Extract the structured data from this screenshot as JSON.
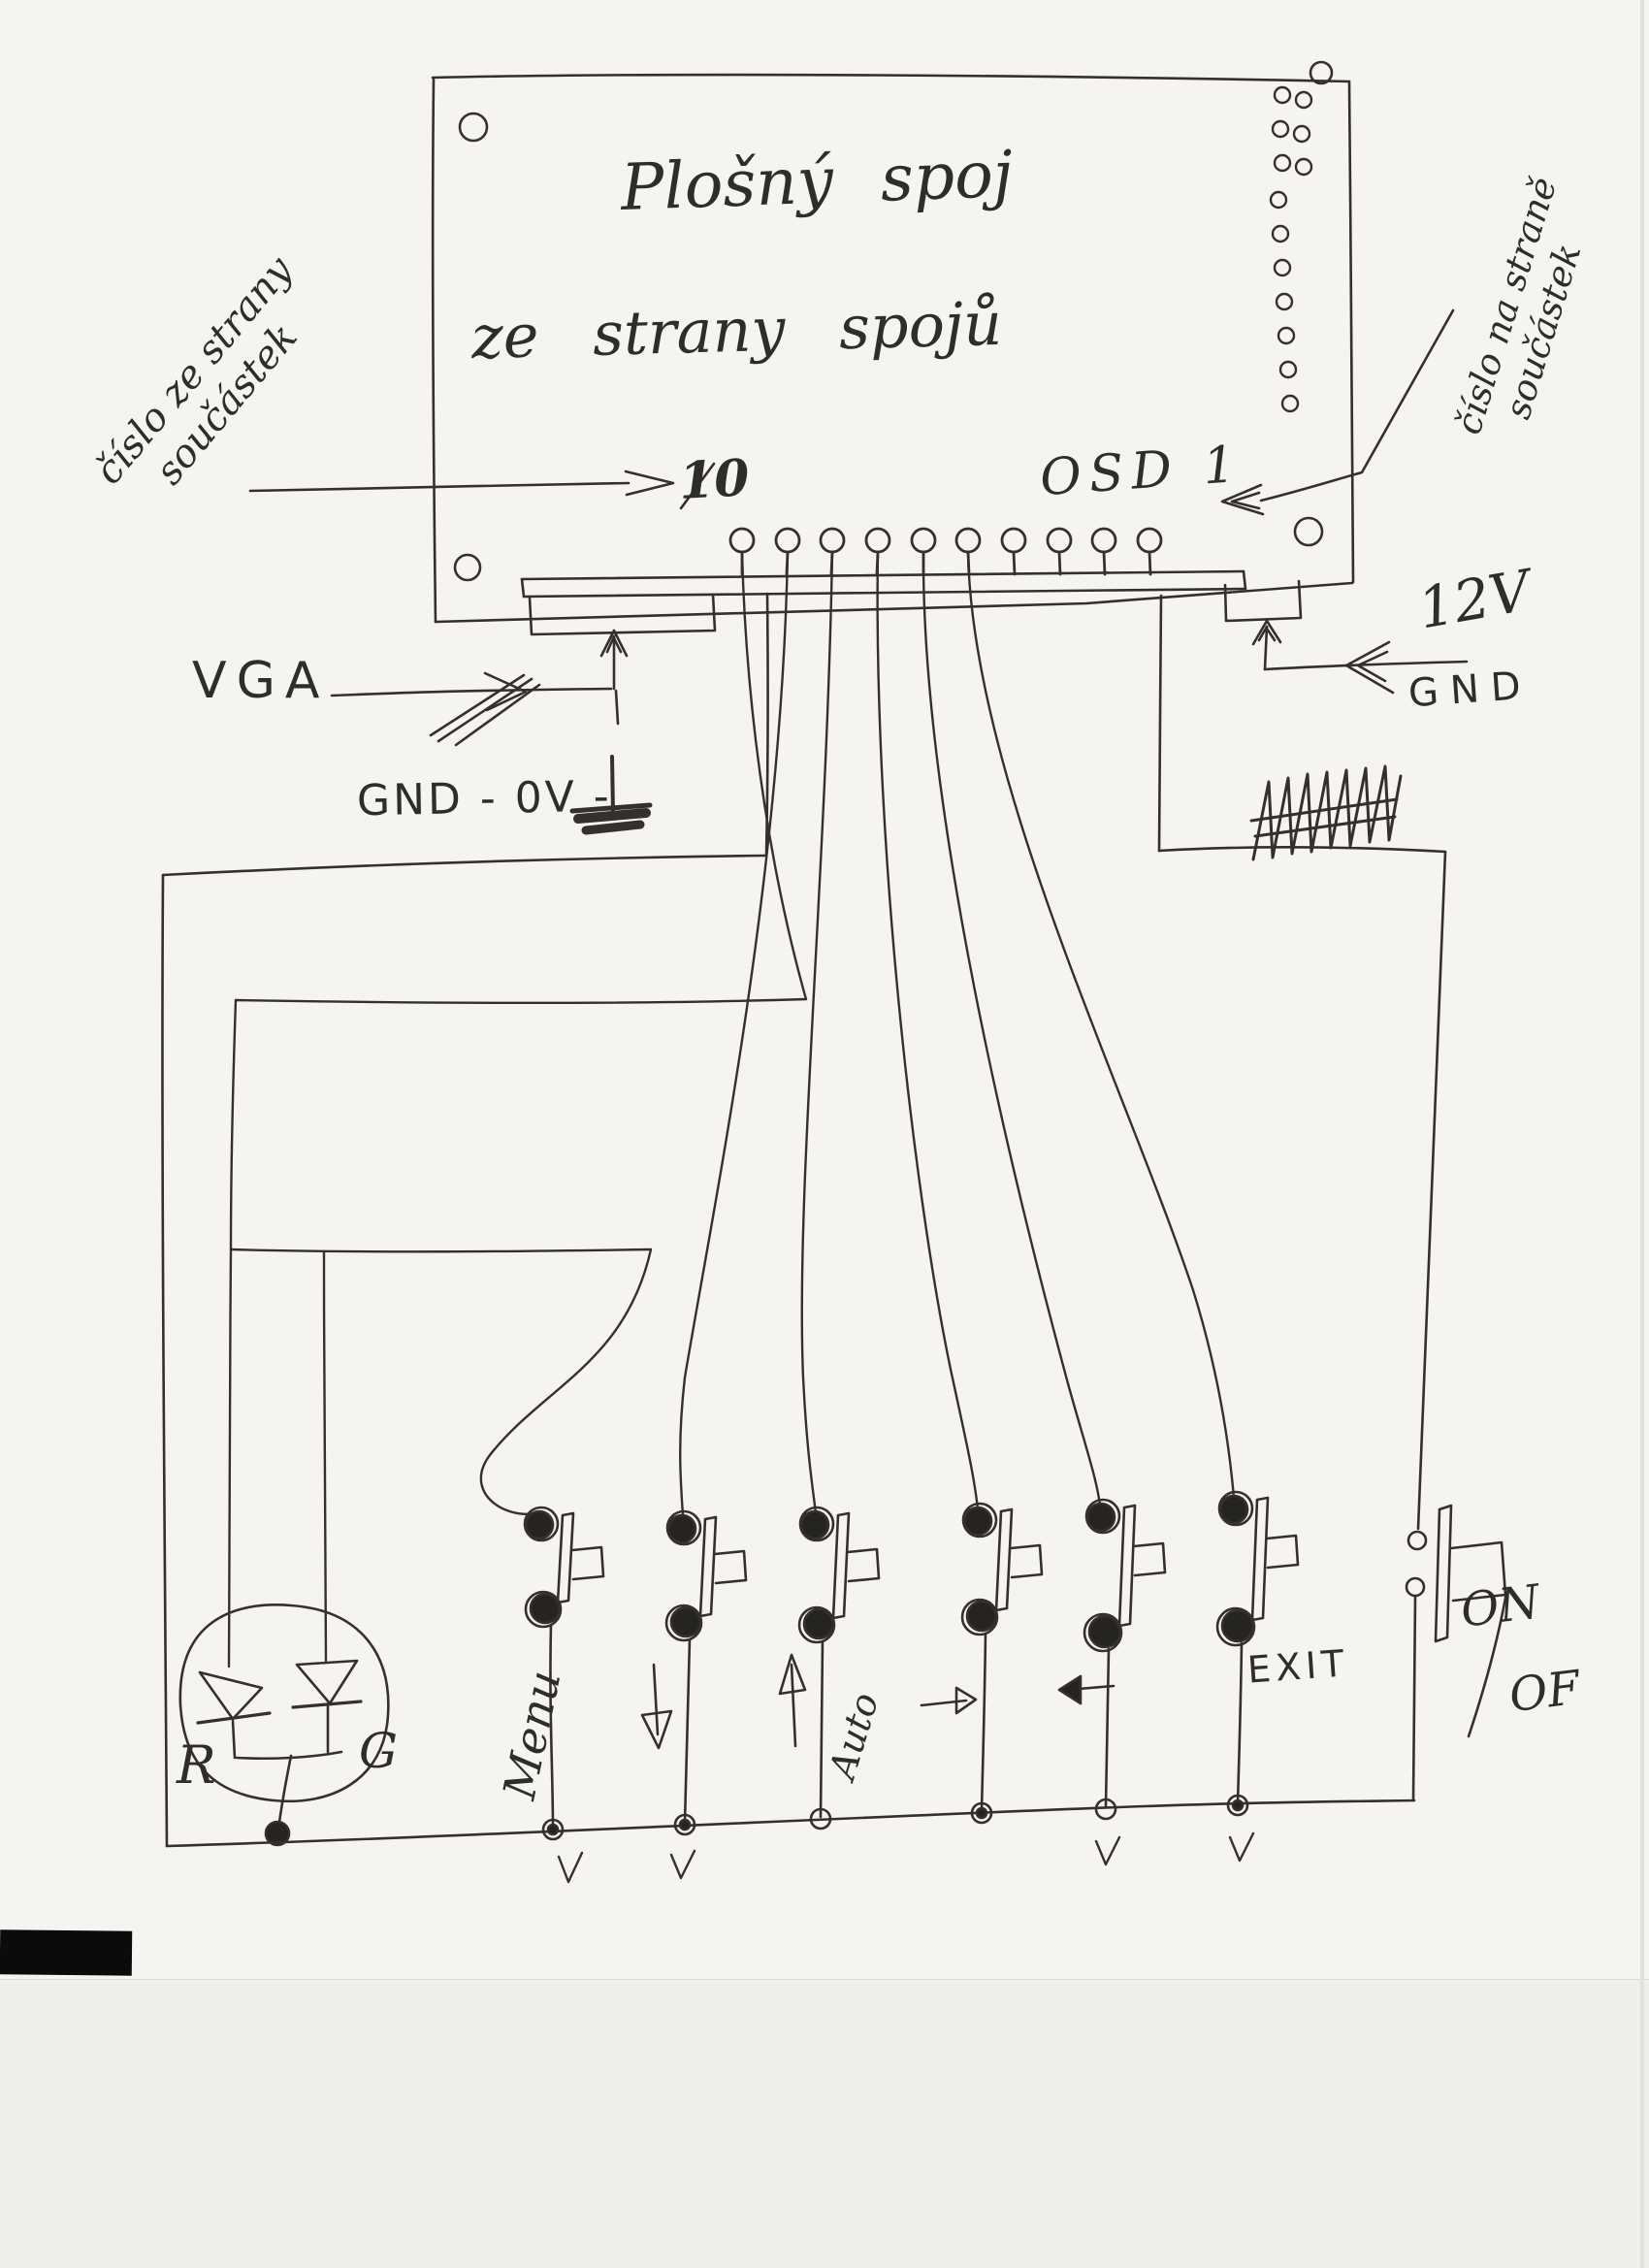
{
  "page": {
    "background": "#f5f4f1",
    "ink": "#34312d"
  },
  "title": {
    "line1": "Plošný spoj",
    "line2": "ze strany spojů"
  },
  "annotations": {
    "left_note_line1": "číslo ze strany",
    "left_note_line2": "součástek",
    "right_note_line1": "číslo na straně",
    "right_note_line2": "součástek",
    "pin_left": "10",
    "pin_right": "OSD 1",
    "vga": "VGA",
    "gnd_0v": "GND - 0V -",
    "v12": "12V",
    "gnd": "GND",
    "on": "ON",
    "off": "OF"
  },
  "led": {
    "left": "R",
    "right": "G"
  },
  "board": {
    "pin_count": 10
  },
  "buttons": [
    {
      "name": "menu",
      "label": "Menu",
      "icon": ""
    },
    {
      "name": "down",
      "label": "",
      "icon": "down-arrow"
    },
    {
      "name": "auto",
      "label": "Auto",
      "icon": "up-arrow"
    },
    {
      "name": "right",
      "label": "",
      "icon": "right-arrow"
    },
    {
      "name": "left",
      "label": "",
      "icon": "left-arrow"
    },
    {
      "name": "exit",
      "label": "EXIT",
      "icon": ""
    },
    {
      "name": "power",
      "label": "ON/OF",
      "icon": ""
    }
  ]
}
